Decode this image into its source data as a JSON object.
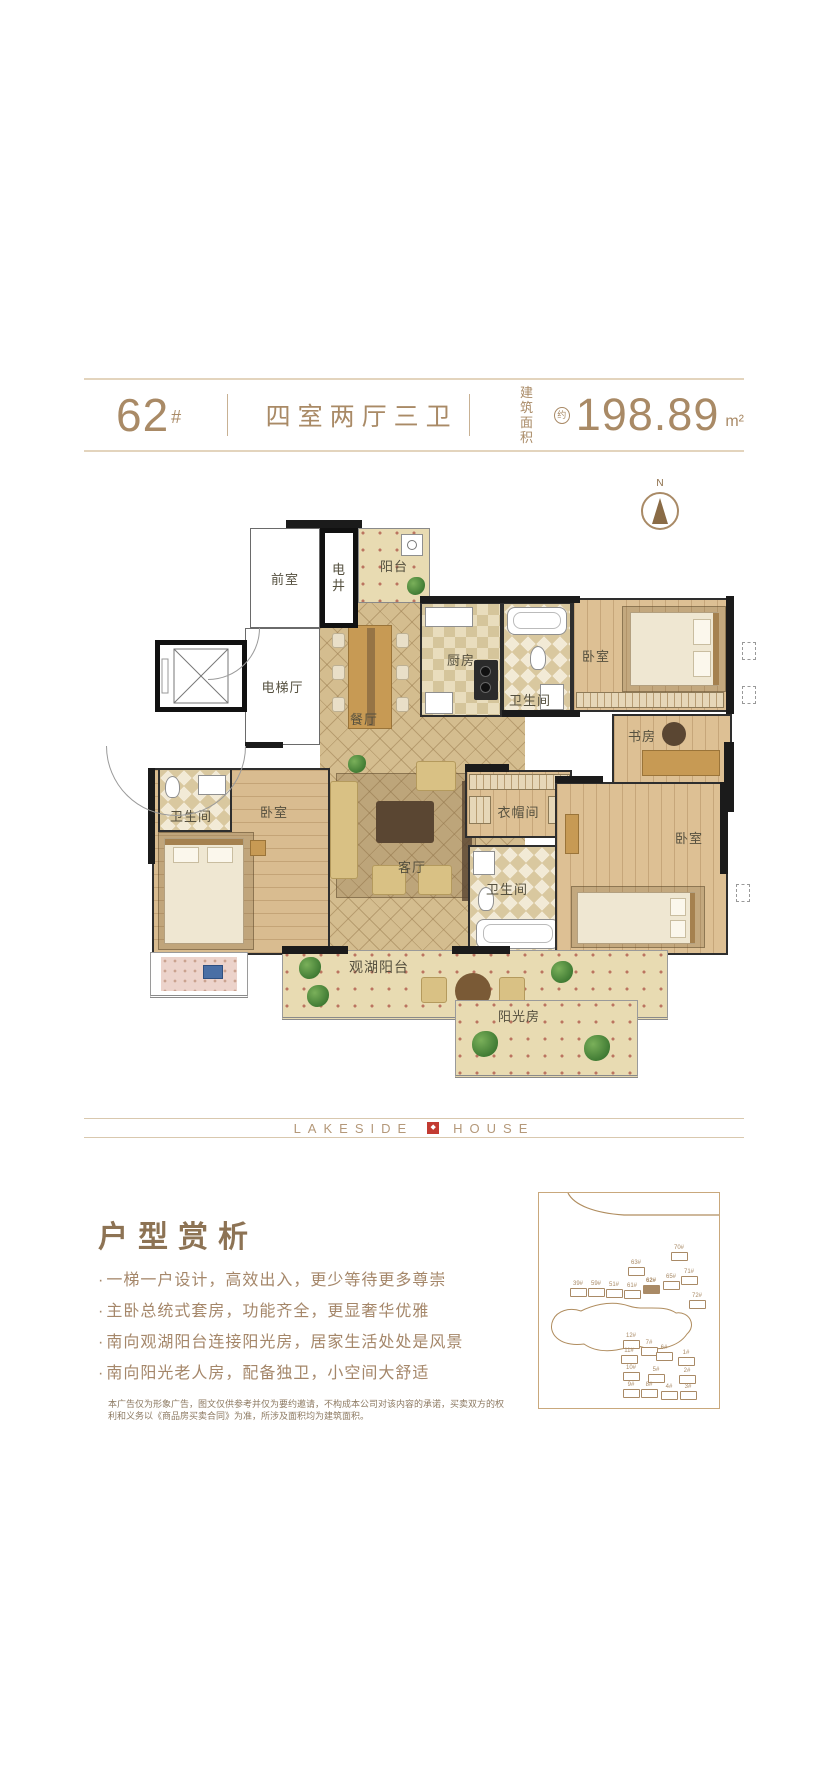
{
  "header": {
    "building_no": "62",
    "building_no_suffix": "#",
    "layout_type": "四室两厅三卫",
    "area_label_top": "建筑",
    "area_label_bottom": "面积",
    "area_qualifier": "约",
    "area_value": "198.89",
    "area_unit": "m²"
  },
  "plan": {
    "compass": "N",
    "rooms": {
      "antechamber": "前室",
      "utility_shaft": "电井",
      "north_balcony": "阳台",
      "kitchen": "厨房",
      "elevator_hall": "电梯厅",
      "dining_room": "餐厅",
      "bathroom_north": "卫生间",
      "bedroom_northeast": "卧室",
      "study": "书房",
      "bathroom_west": "卫生间",
      "bedroom_west": "卧室",
      "living_room": "客厅",
      "cloakroom": "衣帽间",
      "bathroom_center": "卫生间",
      "bedroom_southeast": "卧室",
      "lakeview_balcony": "观湖阳台",
      "sunroom": "阳光房"
    }
  },
  "brand": {
    "left": "LAKESIDE",
    "right": "HOUSE",
    "mark": "◆"
  },
  "analysis": {
    "title": "户型赏析",
    "bullet_marker": "·",
    "bullets": [
      "一梯一户设计，高效出入，更少等待更多尊崇",
      "主卧总统式套房，功能齐全，更显奢华优雅",
      "南向观湖阳台连接阳光房，居家生活处处是风景",
      "南向阳光老人房，配备独卫，小空间大舒适"
    ]
  },
  "disclaimer": "本广告仅为形象广告，图文仅供参考并仅为要约邀请，不构成本公司对该内容的承诺，买卖双方的权利和义务以《商品房买卖合同》为准，所涉及面积均为建筑面积。",
  "site_map": {
    "buildings": [
      {
        "label": "39#",
        "x": 30,
        "y": 88,
        "active": false
      },
      {
        "label": "59#",
        "x": 48,
        "y": 88,
        "active": false
      },
      {
        "label": "51#",
        "x": 66,
        "y": 89,
        "active": false
      },
      {
        "label": "61#",
        "x": 84,
        "y": 90,
        "active": false
      },
      {
        "label": "63#",
        "x": 88,
        "y": 67,
        "active": false
      },
      {
        "label": "62#",
        "x": 103,
        "y": 85,
        "active": true
      },
      {
        "label": "65#",
        "x": 123,
        "y": 81,
        "active": false
      },
      {
        "label": "71#",
        "x": 141,
        "y": 76,
        "active": false
      },
      {
        "label": "70#",
        "x": 131,
        "y": 52,
        "active": false
      },
      {
        "label": "72#",
        "x": 149,
        "y": 100,
        "active": false
      },
      {
        "label": "12#",
        "x": 83,
        "y": 140,
        "active": false
      },
      {
        "label": "7#",
        "x": 101,
        "y": 147,
        "active": false
      },
      {
        "label": "6#",
        "x": 116,
        "y": 152,
        "active": false
      },
      {
        "label": "1#",
        "x": 138,
        "y": 157,
        "active": false
      },
      {
        "label": "11#",
        "x": 81,
        "y": 155,
        "active": false
      },
      {
        "label": "10#",
        "x": 83,
        "y": 172,
        "active": false
      },
      {
        "label": "5#",
        "x": 108,
        "y": 174,
        "active": false
      },
      {
        "label": "2#",
        "x": 139,
        "y": 175,
        "active": false
      },
      {
        "label": "9#",
        "x": 83,
        "y": 189,
        "active": false
      },
      {
        "label": "8#",
        "x": 101,
        "y": 189,
        "active": false
      },
      {
        "label": "4#",
        "x": 121,
        "y": 191,
        "active": false
      },
      {
        "label": "3#",
        "x": 140,
        "y": 191,
        "active": false
      }
    ]
  },
  "colors": {
    "accent": "#a98a66",
    "brand_red": "#c23b32",
    "wall": "#1b1b1b"
  }
}
